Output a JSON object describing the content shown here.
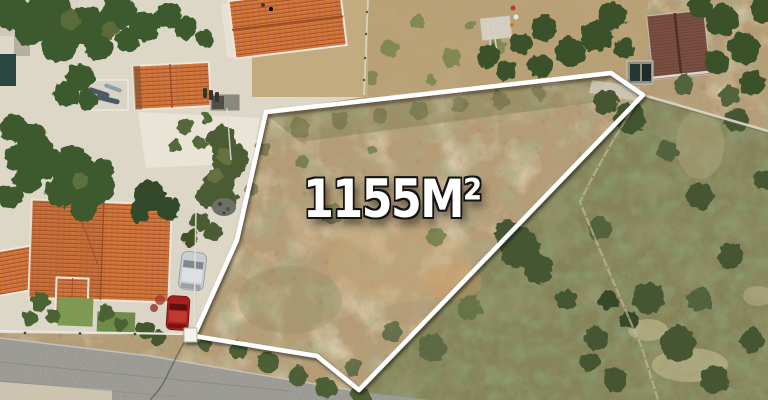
{
  "scene": {
    "type": "aerial-drone-photo",
    "subject": "Vacant building plot outlined in white between houses, road and scrubland",
    "area_label": "1155M²",
    "plot": {
      "boundary_points": "266,112 611,73 643,95 359,390 317,356 194,336 237,240"
    },
    "colors": {
      "plot_dirt": "#b59c77",
      "top_lot_dirt": "#b9a176",
      "scrub_green": "#6f774b",
      "gravel": "#ddd7c8",
      "driveway": "#dad5c7",
      "road": "#9b9a95",
      "concrete_pad": "#cdc4af",
      "roof_orange": "#cf7339",
      "roof_dark": "#7a5043",
      "tree_green": "#3e5a2f",
      "lawn": "#7d9952",
      "outline": "#ffffff",
      "car_silver": "#c9cdd0",
      "car_red": "#a8201b"
    }
  }
}
